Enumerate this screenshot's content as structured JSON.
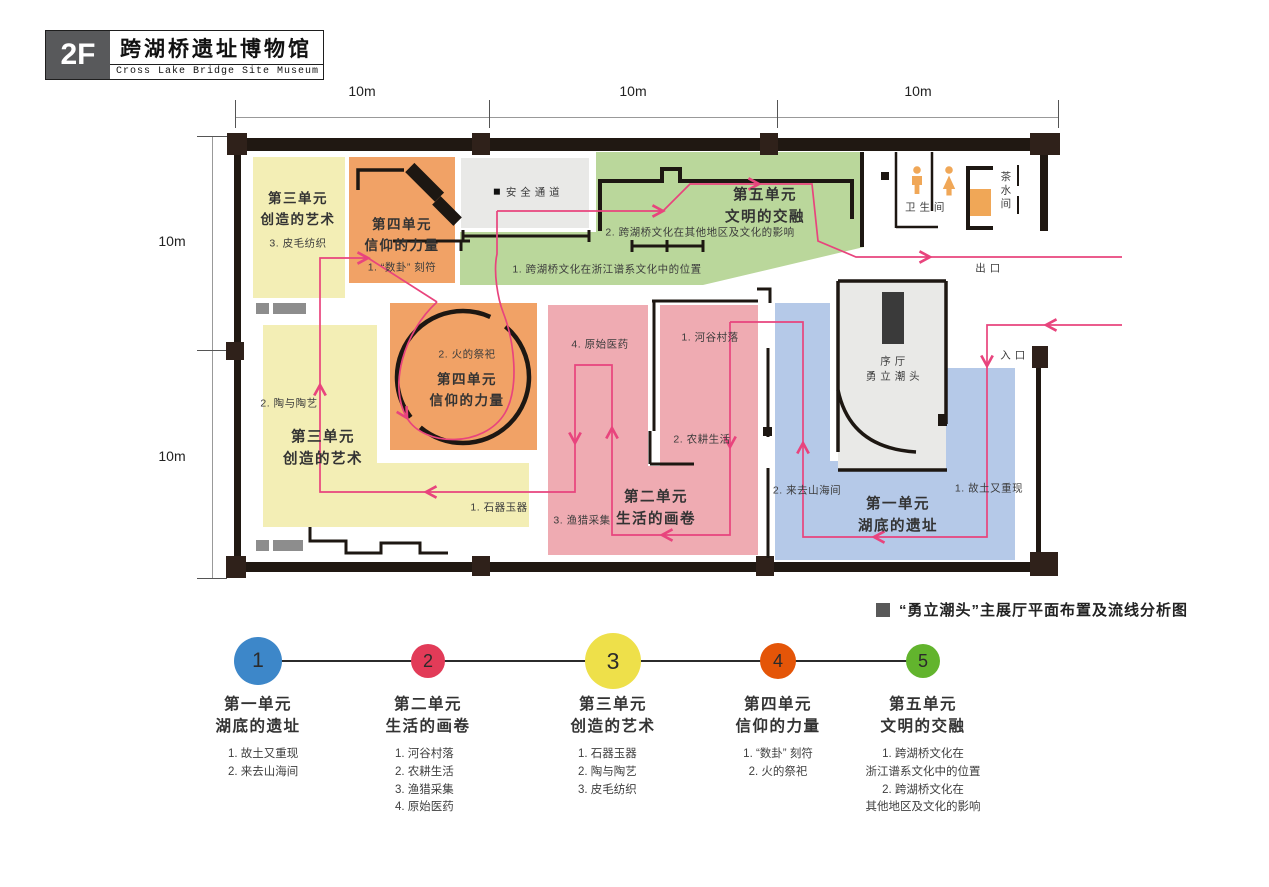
{
  "header": {
    "floor": "2F",
    "title_zh": "跨湖桥遗址博物馆",
    "title_en": "Cross Lake Bridge Site Museum"
  },
  "dimensions": {
    "top_labels": [
      "10m",
      "10m",
      "10m"
    ],
    "side_labels": [
      "10m",
      "10m"
    ]
  },
  "plan": {
    "rooms": {
      "safety": "安 全 通 道",
      "wc": "卫 生 间",
      "tea": "茶水间",
      "exit": "出 口",
      "entry": "入 口",
      "hall": "序 厅\n勇 立 潮 头"
    },
    "labels": {
      "zoneA_title": "第三单元\n创造的艺术",
      "zoneA_item": "3. 皮毛纺织",
      "zoneB_title": "第四单元\n信仰的力量",
      "zoneB_item": "1. “数卦” 刻符",
      "green_title": "第五单元\n文明的交融",
      "green_item1": "1. 跨湖桥文化在浙江谱系文化中的位置",
      "green_item2": "2. 跨湖桥文化在其他地区及文化的影响",
      "fire_item": "2. 火的祭祀",
      "fire_title": "第四单元\n信仰的力量",
      "pottery_item": "2. 陶与陶艺",
      "unit3_title": "第三单元\n创造的艺术",
      "stone_item": "1. 石器玉器",
      "med_item": "4. 原始医药",
      "valley_item": "1. 河谷村落",
      "farm_item": "2. 农耕生活",
      "unit2_title": "第二单元\n生活的画卷",
      "fish_item": "3. 渔猎采集",
      "sea_item": "2. 来去山海间",
      "unit1_title": "第一单元\n湖底的遗址",
      "home_item": "1. 故土又重现"
    },
    "colors": {
      "unit1_blue": "#b5c9e8",
      "unit2_pink": "#efabb2",
      "unit3_yellow": "#f3eeb5",
      "unit4_orange": "#f1a266",
      "unit5_green": "#bad79b",
      "hall_gray": "#e9e9e7",
      "flow_line": "#e8447d",
      "wall": "#201812"
    }
  },
  "caption": {
    "text": "“勇立潮头”主展厅平面布置及流线分析图"
  },
  "legend": {
    "units": [
      {
        "num": "1",
        "color": "#3d87c9",
        "title": "第一单元\n湖底的遗址",
        "items": "1. 故土又重现\n2. 来去山海间"
      },
      {
        "num": "2",
        "color": "#e23b58",
        "title": "第二单元\n生活的画卷",
        "items": "1. 河谷村落\n2. 农耕生活\n3. 渔猎采集\n4. 原始医药"
      },
      {
        "num": "3",
        "color": "#eee04a",
        "title": "第三单元\n创造的艺术",
        "items": "1. 石器玉器\n2. 陶与陶艺\n3. 皮毛纺织"
      },
      {
        "num": "4",
        "color": "#e45508",
        "title": "第四单元\n信仰的力量",
        "items": "1. “数卦” 刻符\n2. 火的祭祀"
      },
      {
        "num": "5",
        "color": "#62b42d",
        "title": "第五单元\n文明的交融",
        "items": "1. 跨湖桥文化在\n浙江谱系文化中的位置\n2. 跨湖桥文化在\n其他地区及文化的影响"
      }
    ]
  }
}
